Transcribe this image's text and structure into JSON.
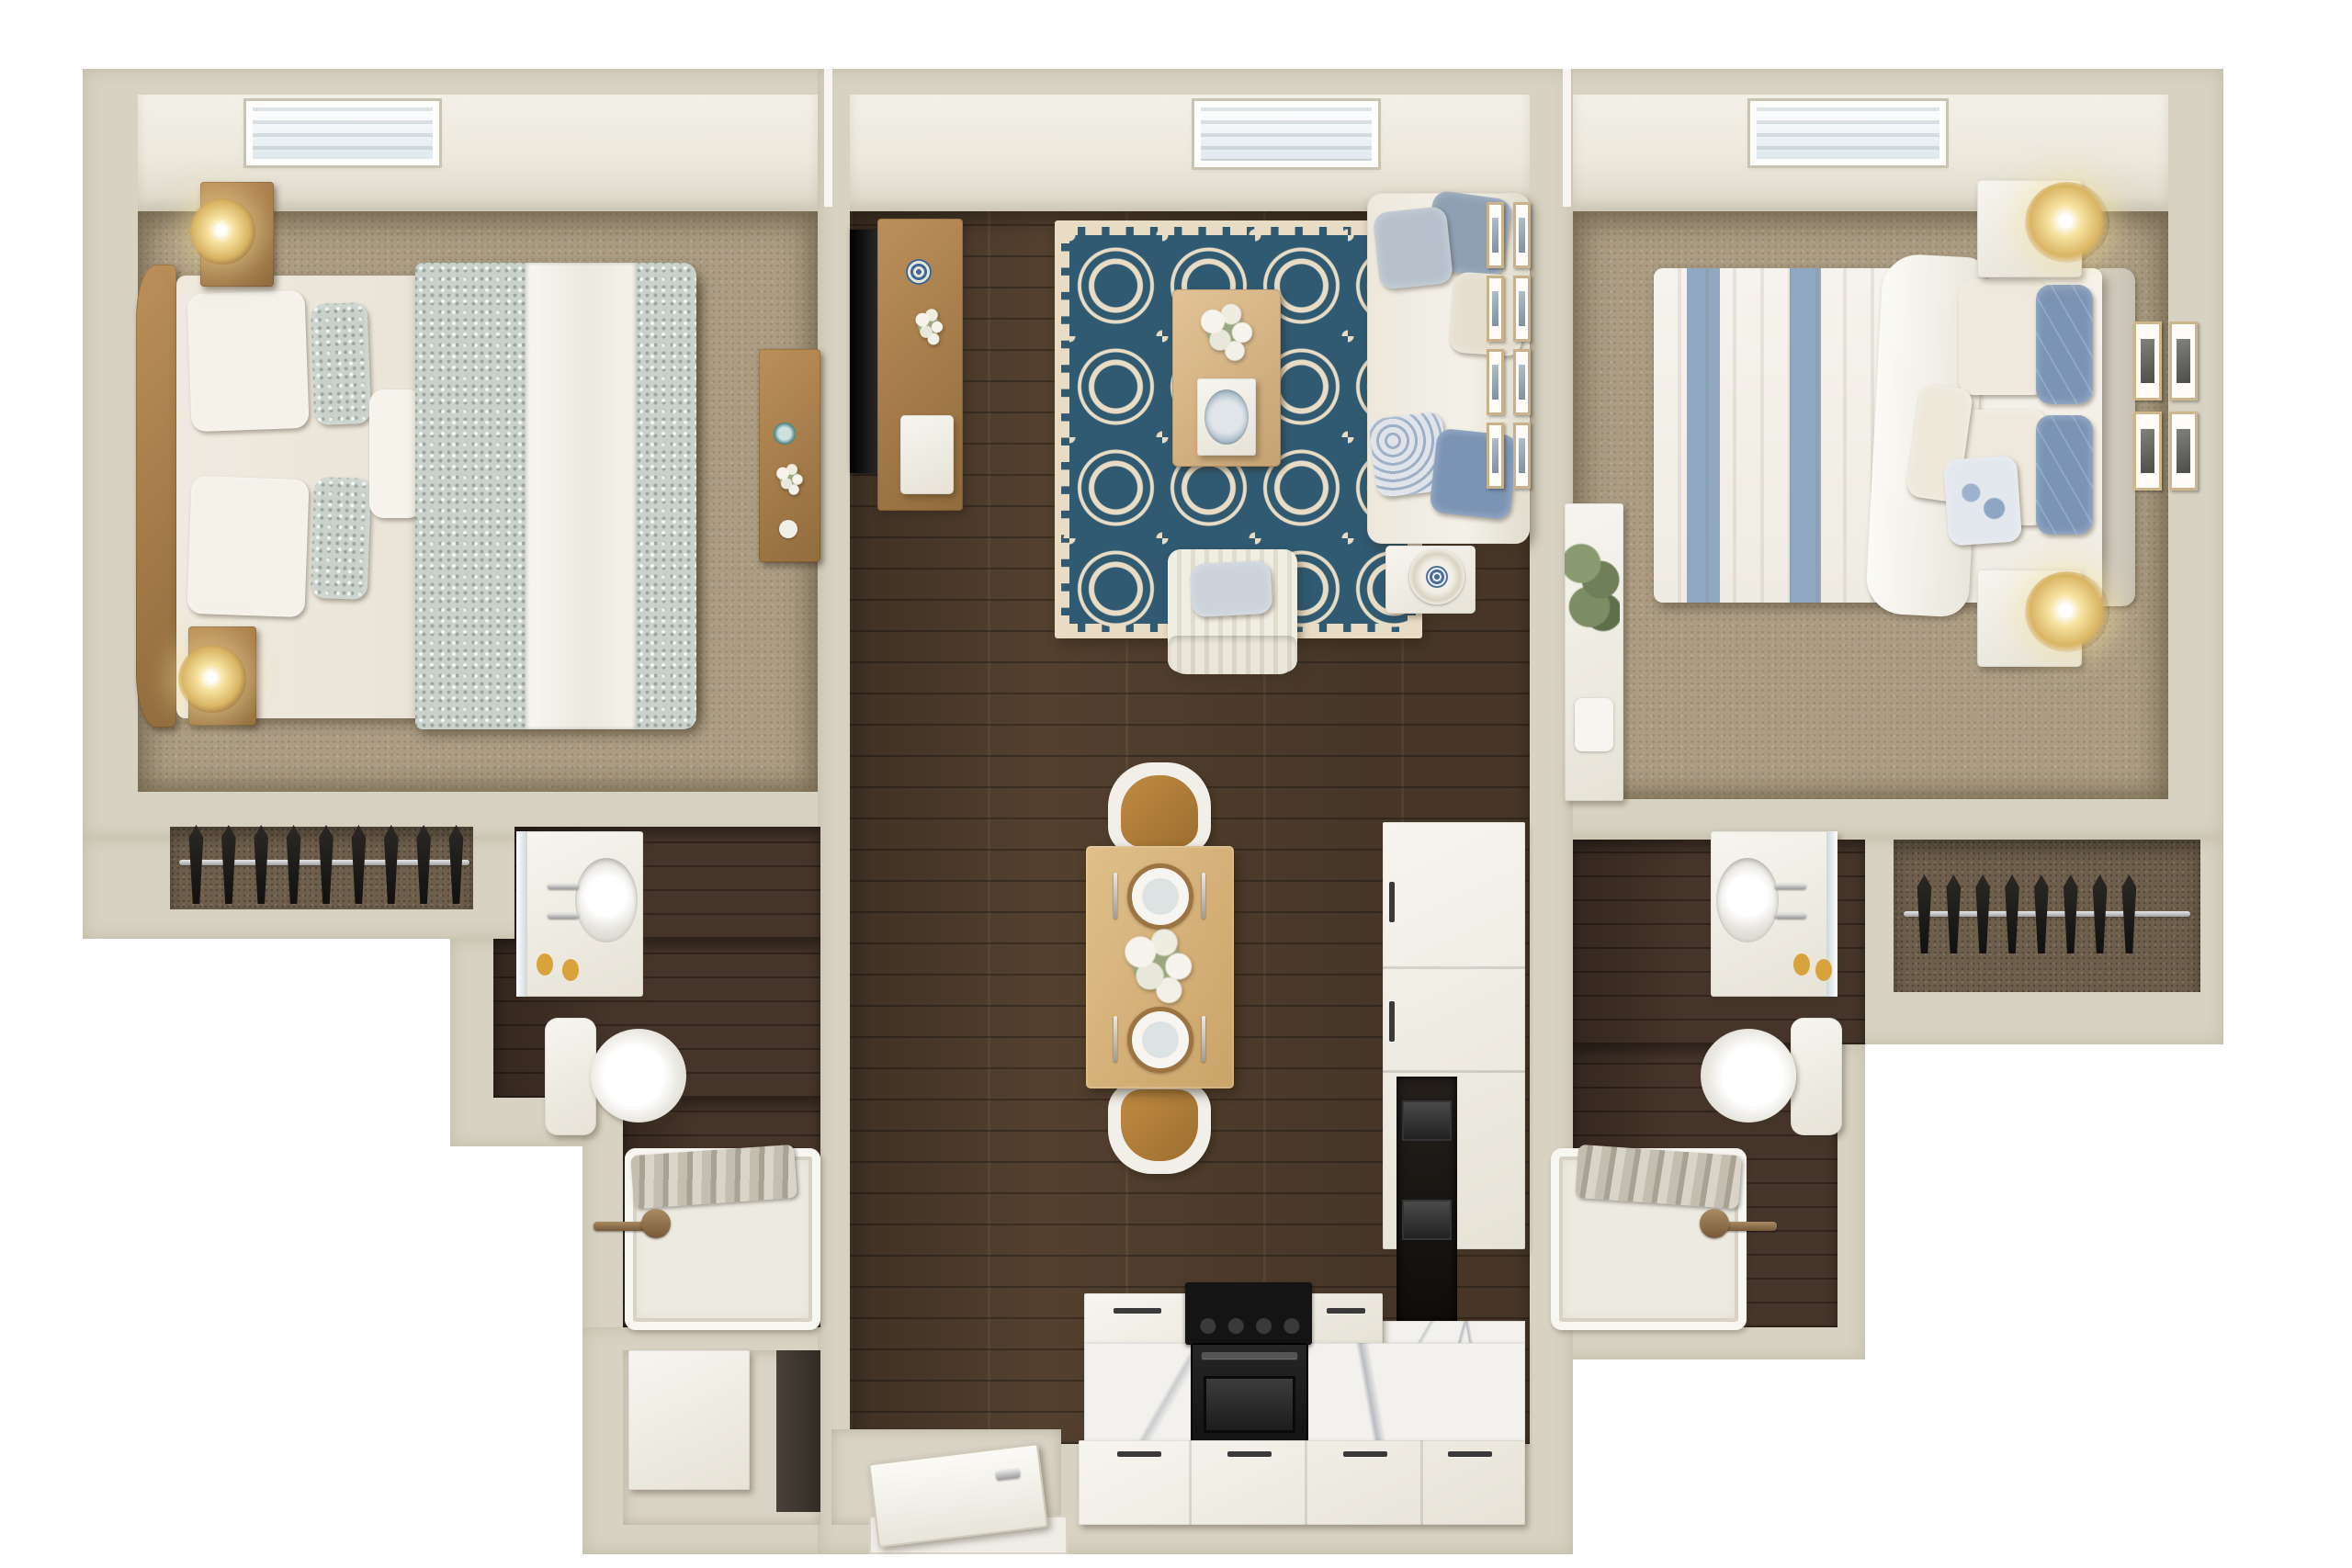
{
  "image_type": "3d-rendered-apartment-floor-plan",
  "rooms": [
    "bedroom-left",
    "living-room",
    "bedroom-right",
    "closet-left",
    "bathroom-left",
    "closet-right",
    "bathroom-right",
    "dining-area",
    "kitchen",
    "entry",
    "storage-room"
  ],
  "counts": {
    "skylights": 3,
    "left_closet_garments": 9,
    "right_closet_garments": 8,
    "living_wall_frames": 8,
    "bedroom_wall_frames": 4,
    "dining_chairs": 2,
    "dining_place_settings": 2
  },
  "palette": {
    "exterior": "#ffffff",
    "wall": "#d8d2c2",
    "ceiling": "#ece8dc",
    "carpet": "#ab9c83",
    "wood": "#53402f",
    "bath_wood": "#46352a",
    "closet_back": "#6e5f4c",
    "tile": "#d9d3c5",
    "rug_navy": "#2f5a72",
    "rug_cream": "#e8dcc4",
    "white_soft": "#f1eee6",
    "furn_wood": "#a9804f",
    "table_wood": "#dcba84",
    "marble": "#f3f1ed",
    "marble_vein": "#b9bcc0",
    "appliance_black": "#181818",
    "pillow_blue": "#7b93b4",
    "pillow_slate": "#8ea0b4",
    "cream": "#e6dfd0",
    "duvet_sage": "#c9d1cb",
    "stripe_blue": "#8aa3c0",
    "gold": "#d9b564",
    "glow": "#f7e3a1",
    "bronze": "#8a6f4e",
    "chrome": "#c9c9c9",
    "soap": "#d9a33c",
    "plant": "#6f7f5a",
    "towel": "#b5afa2"
  }
}
